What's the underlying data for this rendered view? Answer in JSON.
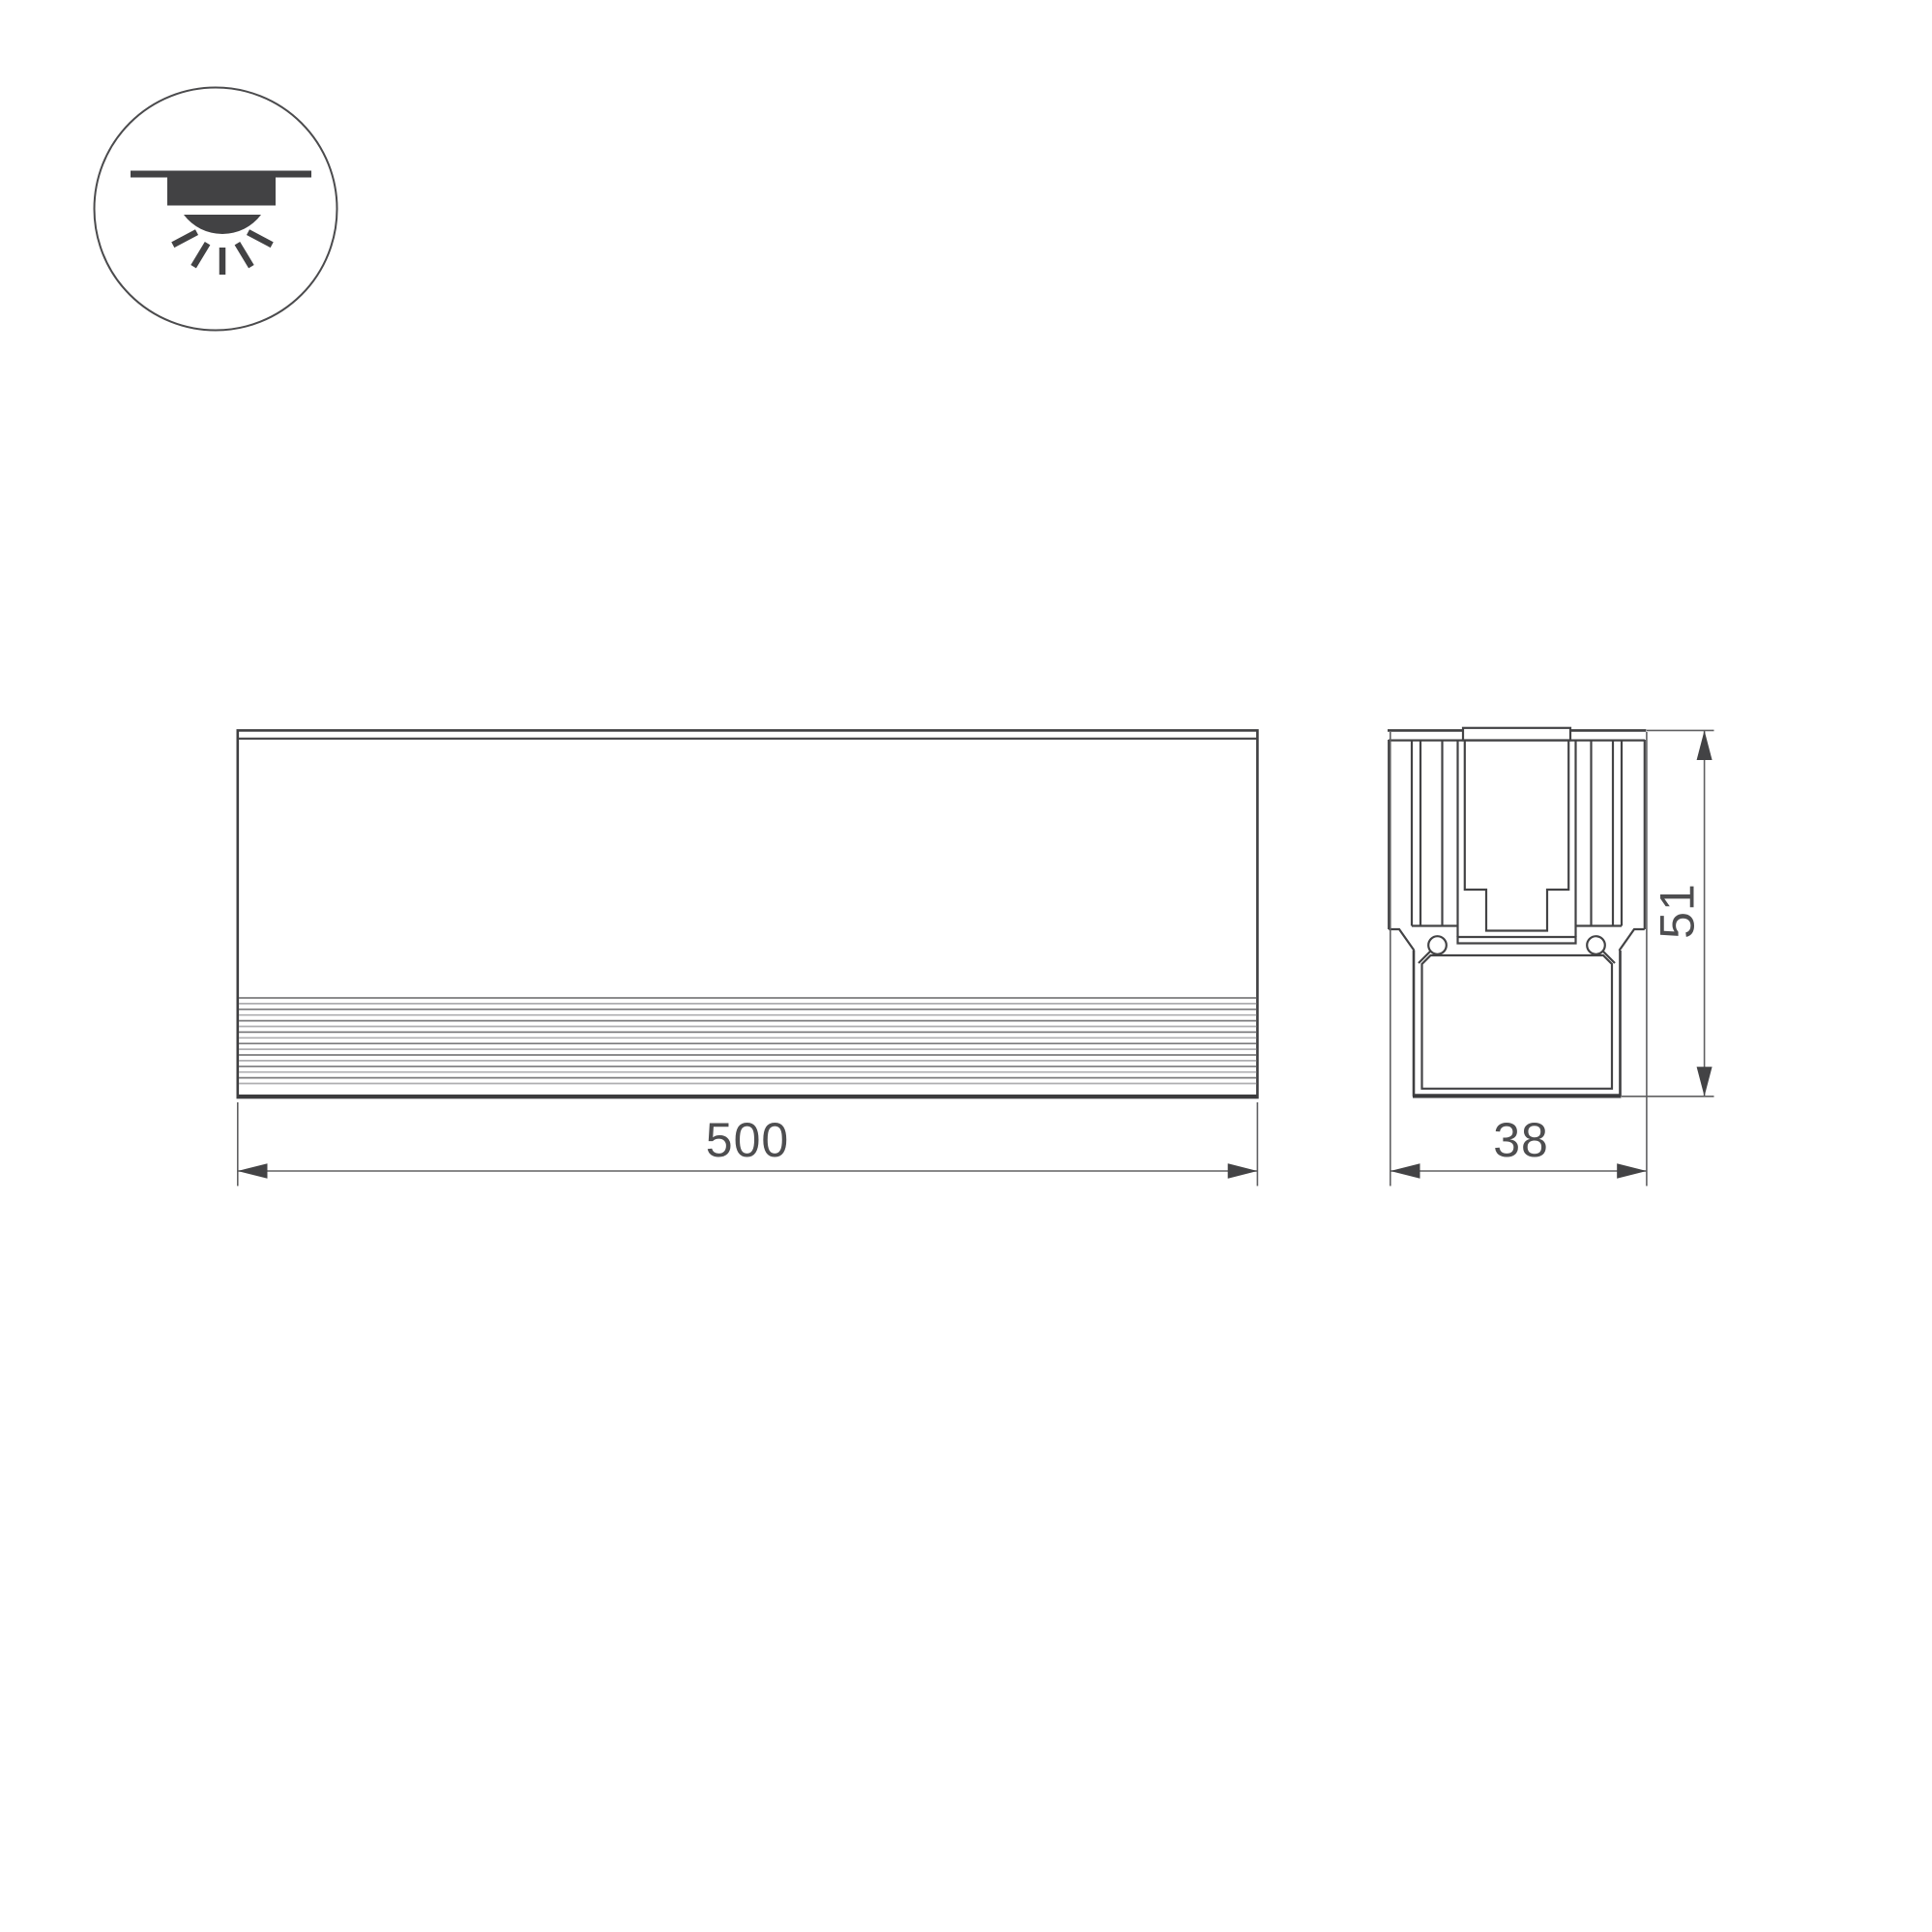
{
  "background_color": "#ffffff",
  "line_color": "#434345",
  "text_color": "#4e4e50",
  "icon": {
    "name": "recessed-downlight-icon",
    "depicts": "ceiling recessed luminaire emitting light downward"
  },
  "views": {
    "front": {
      "name": "front-view",
      "length": {
        "label": "500"
      }
    },
    "section": {
      "name": "section-view",
      "width": {
        "label": "38"
      },
      "height": {
        "label": "51"
      }
    }
  }
}
